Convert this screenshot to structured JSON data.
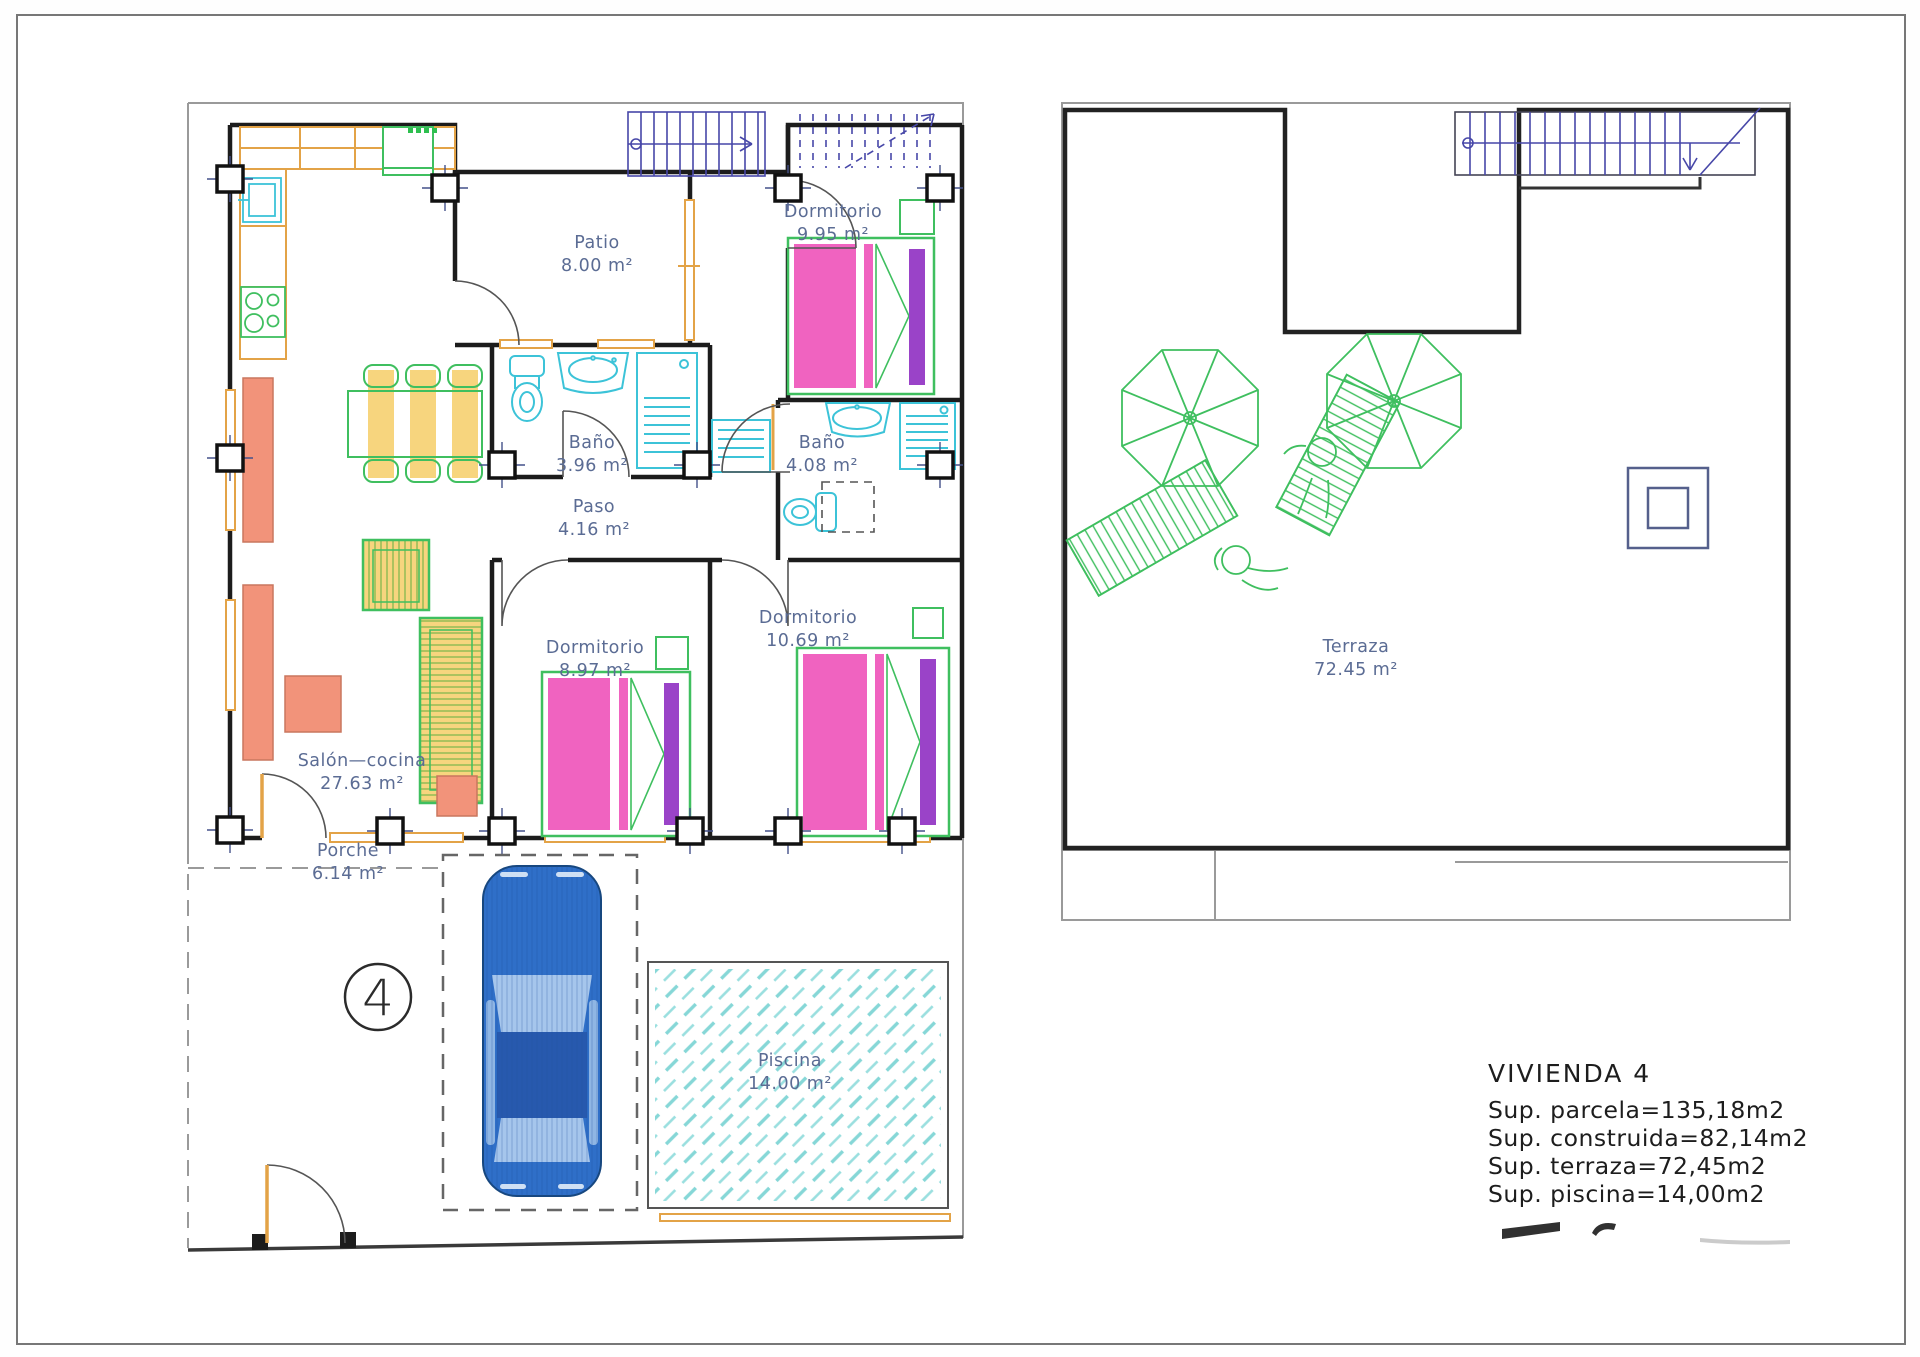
{
  "drawing_type": "floor-plan",
  "ground_floor": {
    "rooms": [
      {
        "name": "Patio",
        "area": "8.00 m²"
      },
      {
        "name": "Dormitorio",
        "area": "9.95 m²"
      },
      {
        "name": "Baño",
        "area": "3.96 m²"
      },
      {
        "name": "Baño",
        "area": "4.08 m²"
      },
      {
        "name": "Paso",
        "area": "4.16 m²"
      },
      {
        "name": "Dormitorio",
        "area": "8.97 m²"
      },
      {
        "name": "Dormitorio",
        "area": "10.69 m²"
      },
      {
        "name": "Salón—cocina",
        "area": "27.63 m²"
      },
      {
        "name": "Porche",
        "area": "6.14 m²"
      },
      {
        "name": "Piscina",
        "area": "14.00 m²"
      }
    ]
  },
  "terrace": {
    "rooms": [
      {
        "name": "Terraza",
        "area": "72.45 m²"
      }
    ]
  },
  "unit_marker": {
    "number": "4"
  },
  "title_block": {
    "title": "VIVIENDA  4",
    "lines": [
      "Sup.  parcela=135,18m2",
      "Sup.  construida=82,14m2",
      "Sup.  terraza=72,45m2",
      "Sup.  piscina=14,00m2"
    ]
  },
  "colors": {
    "wall": "#1c1c1c",
    "boundary": "#9a9a9a",
    "label_text": "#5b6c94",
    "stairs_navy": "#4747a8",
    "carpentry_orange": "#e3a347",
    "furniture_salmon": "#f2937a",
    "furniture_green": "#3fbf5f",
    "bed_pink": "#f063c0",
    "bed_purple": "#9a43c8",
    "sanitary_cyan": "#3cc3d8",
    "pool_hatch": "#86d7d7",
    "car_blue": "#2f6fc8",
    "seat_yellow": "#f7d57e"
  }
}
